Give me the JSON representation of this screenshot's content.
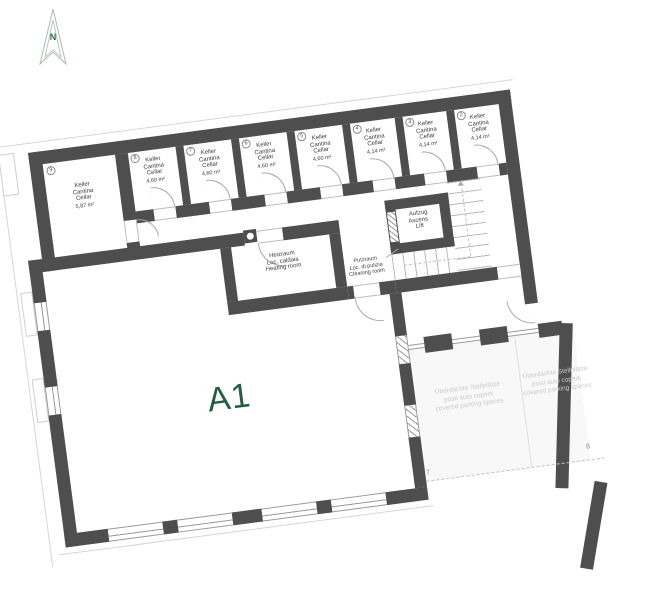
{
  "compass": {
    "label": "N"
  },
  "apartment": {
    "label": "A1",
    "color": "#235e41"
  },
  "colors": {
    "wall": "#4e4e4e",
    "parking_text": "#cbcbcb",
    "accent_green": "#235e41"
  },
  "cellars": [
    {
      "number": "9",
      "name_de": "Keller",
      "name_it": "Cantina",
      "name_en": "Cellar",
      "area": "5,87 m²"
    },
    {
      "number": "8",
      "name_de": "Keller",
      "name_it": "Cantina",
      "name_en": "Cellar",
      "area": "4,60 m²"
    },
    {
      "number": "7",
      "name_de": "Keller",
      "name_it": "Cantina",
      "name_en": "Cellar",
      "area": "4,60 m²"
    },
    {
      "number": "6",
      "name_de": "Keller",
      "name_it": "Cantina",
      "name_en": "Cellar",
      "area": "4,60 m²"
    },
    {
      "number": "5",
      "name_de": "Keller",
      "name_it": "Cantina",
      "name_en": "Cellar",
      "area": "4,60 m²"
    },
    {
      "number": "4",
      "name_de": "Keller",
      "name_it": "Cantina",
      "name_en": "Cellar",
      "area": "4,14 m²"
    },
    {
      "number": "3",
      "name_de": "Keller",
      "name_it": "Cantina",
      "name_en": "Cellar",
      "area": "4,14 m²"
    },
    {
      "number": "2",
      "name_de": "Keller",
      "name_it": "Cantina",
      "name_en": "Cellar",
      "area": "4,14 m²"
    }
  ],
  "heating_room": {
    "line1": "Heizraum",
    "line2": "Loc. caldaia",
    "line3": "Heating room"
  },
  "lift": {
    "line1": "Aufzug",
    "line2": "Ascens.",
    "line3": "Lift"
  },
  "cleaning_room": {
    "line1": "Putzraum",
    "line2": "Loc. di pulizia",
    "line3": "Cleaning room"
  },
  "parking": {
    "label_de": "Überdachte Stellplätze",
    "label_it": "posti auto coperti",
    "label_en": "covered parking spaces",
    "space_numbers": [
      "7",
      "8"
    ]
  }
}
